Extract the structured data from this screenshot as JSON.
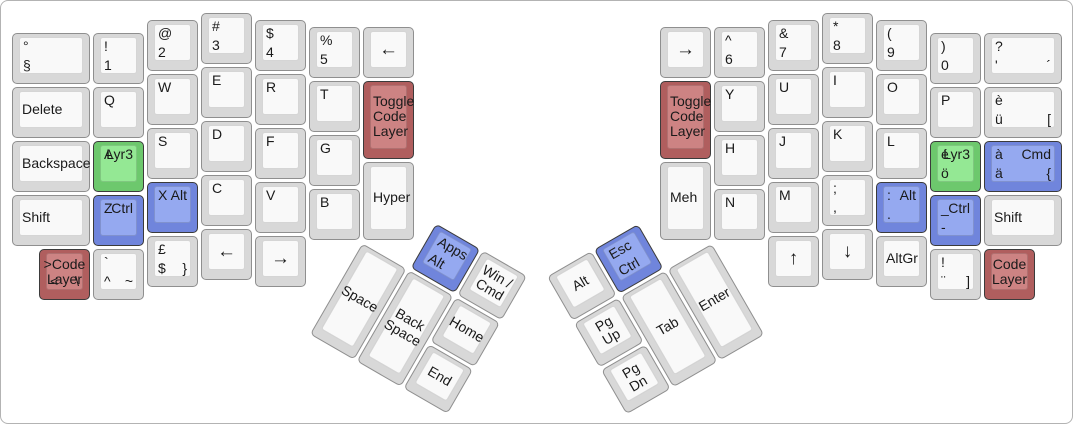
{
  "canvas": {
    "width": 1073,
    "height": 424,
    "unit": 54,
    "margin_x": 10,
    "margin_y": 11,
    "background": "#ffffff",
    "border_color": "#b3b3b3"
  },
  "colors": {
    "gray": {
      "side": "#d8d8d8",
      "face": "#f9f9f9",
      "border": "#8f8f8f"
    },
    "green": {
      "side": "#6dc86d",
      "face": "#94e894",
      "border": "#3b3b3b"
    },
    "blue": {
      "side": "#7085dc",
      "face": "#95a9f0",
      "border": "#3b3b3b"
    },
    "red": {
      "side": "#b05e5e",
      "face": "#cd8383",
      "border": "#3b3b3b"
    }
  },
  "keyboard": {
    "main_keys": [
      {
        "id": "deg-sect",
        "x": 0,
        "y": 0.375,
        "w": 1.5,
        "legends": {
          "tl": "°",
          "bl": "§"
        }
      },
      {
        "id": "excl-1",
        "x": 1.5,
        "y": 0.375,
        "legends": {
          "tl": "!",
          "bl": "1"
        }
      },
      {
        "id": "at-2",
        "x": 2.5,
        "y": 0.125,
        "legends": {
          "tl": "@",
          "bl": "2"
        }
      },
      {
        "id": "hash-3",
        "x": 3.5,
        "y": 0,
        "legends": {
          "tl": "#",
          "bl": "3"
        }
      },
      {
        "id": "dollar-4",
        "x": 4.5,
        "y": 0.125,
        "legends": {
          "tl": "$",
          "bl": "4"
        }
      },
      {
        "id": "percent-5",
        "x": 5.5,
        "y": 0.25,
        "legends": {
          "tl": "%",
          "bl": "5"
        }
      },
      {
        "id": "arrow-left-top",
        "x": 6.5,
        "y": 0.25,
        "arrow": true,
        "legends": {
          "c": "←"
        }
      },
      {
        "id": "delete",
        "x": 0,
        "y": 1.375,
        "w": 1.5,
        "align": "cl",
        "legends": {
          "c": "Delete"
        }
      },
      {
        "id": "q",
        "x": 1.5,
        "y": 1.375,
        "legends": {
          "tl": "Q"
        }
      },
      {
        "id": "w",
        "x": 2.5,
        "y": 1.125,
        "legends": {
          "tl": "W"
        }
      },
      {
        "id": "e",
        "x": 3.5,
        "y": 1,
        "legends": {
          "tl": "E"
        }
      },
      {
        "id": "r",
        "x": 4.5,
        "y": 1.125,
        "legends": {
          "tl": "R"
        }
      },
      {
        "id": "t",
        "x": 5.5,
        "y": 1.25,
        "legends": {
          "tl": "T"
        }
      },
      {
        "id": "toggle-code-layer-left",
        "x": 6.5,
        "y": 1.25,
        "h": 1.5,
        "color": "red",
        "align": "cl",
        "legends": {
          "c": "Toggle\nCode\nLayer"
        }
      },
      {
        "id": "backspace",
        "x": 0,
        "y": 2.375,
        "w": 1.5,
        "align": "cl",
        "legends": {
          "c": "Backspace"
        }
      },
      {
        "id": "a-lyr3",
        "x": 1.5,
        "y": 2.375,
        "color": "green",
        "legends": {
          "tl": "A",
          "tr": "Lyr3"
        }
      },
      {
        "id": "s",
        "x": 2.5,
        "y": 2.125,
        "legends": {
          "tl": "S"
        }
      },
      {
        "id": "d",
        "x": 3.5,
        "y": 2,
        "legends": {
          "tl": "D"
        }
      },
      {
        "id": "f",
        "x": 4.5,
        "y": 2.125,
        "legends": {
          "tl": "F"
        }
      },
      {
        "id": "g",
        "x": 5.5,
        "y": 2.25,
        "legends": {
          "tl": "G"
        }
      },
      {
        "id": "hyper",
        "x": 6.5,
        "y": 2.75,
        "h": 1.5,
        "align": "cl",
        "legends": {
          "c": "Hyper"
        }
      },
      {
        "id": "shift-left",
        "x": 0,
        "y": 3.375,
        "w": 1.5,
        "align": "cl",
        "legends": {
          "c": "Shift"
        }
      },
      {
        "id": "z-ctrl",
        "x": 1.5,
        "y": 3.375,
        "color": "blue",
        "legends": {
          "tl": "Z",
          "tr": "Ctrl"
        }
      },
      {
        "id": "x-alt",
        "x": 2.5,
        "y": 3.125,
        "color": "blue",
        "legends": {
          "tl": "X",
          "tr": "Alt"
        }
      },
      {
        "id": "c",
        "x": 3.5,
        "y": 3,
        "legends": {
          "tl": "C"
        }
      },
      {
        "id": "v",
        "x": 4.5,
        "y": 3.125,
        "legends": {
          "tl": "V"
        }
      },
      {
        "id": "b",
        "x": 5.5,
        "y": 3.25,
        "legends": {
          "tl": "B"
        }
      },
      {
        "id": "gt-code-layer",
        "x": 0.5,
        "y": 4.375,
        "color": "red",
        "legends": {
          "c": ">Code\nLayer",
          "bl": "<",
          "br": "\\"
        }
      },
      {
        "id": "grave-caret-tilde",
        "x": 1.5,
        "y": 4.375,
        "legends": {
          "tl": "`",
          "bl": "^",
          "br": "~"
        }
      },
      {
        "id": "pound-dollar-brace",
        "x": 2.5,
        "y": 4.125,
        "legends": {
          "tl": "£",
          "bl": "$",
          "br": "}"
        }
      },
      {
        "id": "arrow-left-bottom",
        "x": 3.5,
        "y": 4,
        "arrow": true,
        "legends": {
          "c": "←"
        }
      },
      {
        "id": "arrow-right-bottom",
        "x": 4.5,
        "y": 4.125,
        "arrow": true,
        "legends": {
          "c": "→"
        }
      },
      {
        "id": "arrow-right-top",
        "x": 12,
        "y": 0.25,
        "arrow": true,
        "legends": {
          "c": "→"
        }
      },
      {
        "id": "caret-6",
        "x": 13,
        "y": 0.25,
        "legends": {
          "tl": "^",
          "bl": "6"
        }
      },
      {
        "id": "amp-7",
        "x": 14,
        "y": 0.125,
        "legends": {
          "tl": "&",
          "bl": "7"
        }
      },
      {
        "id": "asterisk-8",
        "x": 15,
        "y": 0,
        "legends": {
          "tl": "*",
          "bl": "8"
        }
      },
      {
        "id": "lparen-9",
        "x": 16,
        "y": 0.125,
        "legends": {
          "tl": "(",
          "bl": "9"
        }
      },
      {
        "id": "rparen-0",
        "x": 17,
        "y": 0.375,
        "legends": {
          "tl": ")",
          "bl": "0"
        }
      },
      {
        "id": "question-apostrophe",
        "x": 18,
        "y": 0.375,
        "w": 1.5,
        "legends": {
          "tl": "?",
          "bl": "'",
          "br": "´"
        }
      },
      {
        "id": "toggle-code-layer-right",
        "x": 12,
        "y": 1.25,
        "h": 1.5,
        "color": "red",
        "align": "cl",
        "legends": {
          "c": "Toggle\nCode\nLayer"
        }
      },
      {
        "id": "y",
        "x": 13,
        "y": 1.25,
        "legends": {
          "tl": "Y"
        }
      },
      {
        "id": "u",
        "x": 14,
        "y": 1.125,
        "legends": {
          "tl": "U"
        }
      },
      {
        "id": "i",
        "x": 15,
        "y": 1,
        "legends": {
          "tl": "I"
        }
      },
      {
        "id": "o",
        "x": 16,
        "y": 1.125,
        "legends": {
          "tl": "O"
        }
      },
      {
        "id": "p",
        "x": 17,
        "y": 1.375,
        "legends": {
          "tl": "P"
        }
      },
      {
        "id": "e-grave-u-uml",
        "x": 18,
        "y": 1.375,
        "w": 1.5,
        "legends": {
          "tl": "è",
          "bl": "ü",
          "br": "["
        }
      },
      {
        "id": "meh",
        "x": 12,
        "y": 2.75,
        "h": 1.5,
        "align": "cl",
        "legends": {
          "c": "Meh"
        }
      },
      {
        "id": "h",
        "x": 13,
        "y": 2.25,
        "legends": {
          "tl": "H"
        }
      },
      {
        "id": "j",
        "x": 14,
        "y": 2.125,
        "legends": {
          "tl": "J"
        }
      },
      {
        "id": "k",
        "x": 15,
        "y": 2,
        "legends": {
          "tl": "K"
        }
      },
      {
        "id": "l",
        "x": 16,
        "y": 2.125,
        "legends": {
          "tl": "L"
        }
      },
      {
        "id": "e-acute-lyr3",
        "x": 17,
        "y": 2.375,
        "color": "green",
        "legends": {
          "tl": "é",
          "tr": "Lyr3",
          "bl": "ö"
        }
      },
      {
        "id": "a-grave-cmd",
        "x": 18,
        "y": 2.375,
        "w": 1.5,
        "color": "blue",
        "legends": {
          "tl": "à",
          "tr": "Cmd",
          "bl": "ä",
          "br": "{"
        }
      },
      {
        "id": "n",
        "x": 13,
        "y": 3.25,
        "legends": {
          "tl": "N"
        }
      },
      {
        "id": "m",
        "x": 14,
        "y": 3.125,
        "legends": {
          "tl": "M"
        }
      },
      {
        "id": "semicolon-comma",
        "x": 15,
        "y": 3,
        "legends": {
          "tl": ";",
          "bl": ","
        }
      },
      {
        "id": "colon-period-alt",
        "x": 16,
        "y": 3.125,
        "color": "blue",
        "legends": {
          "tl": ":",
          "tr": "Alt",
          "bl": "."
        }
      },
      {
        "id": "underscore-hyphen-ctrl",
        "x": 17,
        "y": 3.375,
        "color": "blue",
        "legends": {
          "tl": "_",
          "tr": "Ctrl",
          "bl": "-"
        }
      },
      {
        "id": "shift-right",
        "x": 18,
        "y": 3.375,
        "w": 1.5,
        "align": "cl",
        "legends": {
          "c": "Shift"
        }
      },
      {
        "id": "arrow-up",
        "x": 14,
        "y": 4.125,
        "arrow": true,
        "legends": {
          "c": "↑"
        }
      },
      {
        "id": "arrow-down",
        "x": 15,
        "y": 4,
        "arrow": true,
        "legends": {
          "c": "↓"
        }
      },
      {
        "id": "altgr",
        "x": 16,
        "y": 4.125,
        "align": "cl",
        "legends": {
          "c": "AltGr"
        }
      },
      {
        "id": "excl-diaeresis",
        "x": 17,
        "y": 4.375,
        "legends": {
          "tl": "!",
          "bl": "¨",
          "br": "]"
        }
      },
      {
        "id": "code-layer-right",
        "x": 18,
        "y": 4.375,
        "color": "red",
        "legends": {
          "c": "Code\nLayer"
        }
      }
    ],
    "thumb_clusters": [
      {
        "id": "left-thumb-cluster",
        "origin_x_u": 6.5,
        "origin_y_u": 4.25,
        "rotation_deg": 30,
        "keys": [
          {
            "id": "apps-alt",
            "lx": 1,
            "ly": -1,
            "color": "blue",
            "legends": {
              "tl": "Apps",
              "bl": "Alt"
            }
          },
          {
            "id": "win-cmd",
            "lx": 2,
            "ly": -1,
            "legends": {
              "c": "Win /\nCmd"
            }
          },
          {
            "id": "space",
            "lx": 0,
            "ly": 0,
            "h": 2,
            "legends": {
              "c": "Space"
            }
          },
          {
            "id": "back-space",
            "lx": 1,
            "ly": 0,
            "h": 2,
            "legends": {
              "c": "Back\nSpace"
            }
          },
          {
            "id": "home",
            "lx": 2,
            "ly": 0,
            "legends": {
              "c": "Home"
            }
          },
          {
            "id": "end",
            "lx": 2,
            "ly": 1,
            "legends": {
              "c": "End"
            }
          }
        ]
      },
      {
        "id": "right-thumb-cluster",
        "origin_x_u": 13,
        "origin_y_u": 4.25,
        "rotation_deg": -30,
        "keys": [
          {
            "id": "alt-thumb",
            "lx": -3,
            "ly": -1,
            "legends": {
              "c": "Alt"
            }
          },
          {
            "id": "esc-ctrl",
            "lx": -2,
            "ly": -1,
            "color": "blue",
            "legends": {
              "tl": "Esc",
              "bl": "Ctrl"
            }
          },
          {
            "id": "pg-up",
            "lx": -3,
            "ly": 0,
            "legends": {
              "c": "Pg Up"
            }
          },
          {
            "id": "tab",
            "lx": -2,
            "ly": 0,
            "h": 2,
            "legends": {
              "c": "Tab"
            }
          },
          {
            "id": "enter",
            "lx": -1,
            "ly": 0,
            "h": 2,
            "legends": {
              "c": "Enter"
            }
          },
          {
            "id": "pg-dn",
            "lx": -3,
            "ly": 1,
            "legends": {
              "c": "Pg Dn"
            }
          }
        ]
      }
    ]
  }
}
